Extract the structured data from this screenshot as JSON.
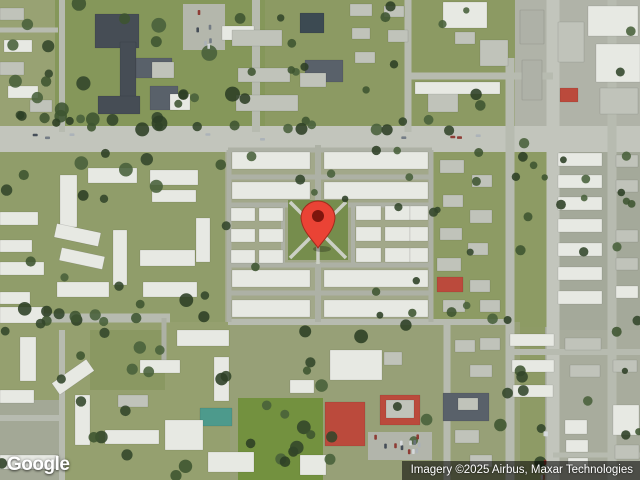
{
  "logo": {
    "text": "Google"
  },
  "attribution": {
    "text": "Imagery ©2025 Airbus, Maxar Technologies"
  },
  "pin": {
    "head_cx": 318,
    "head_cy": 216,
    "head_r": 17,
    "tip_x": 318,
    "tip_y": 248,
    "inner_r": 6,
    "body_color": "#ea4335",
    "border_color": "#a02b1d",
    "inner_color": "#7e150d",
    "shadow_color": "rgba(0,0,0,0.25)"
  },
  "map": {
    "width": 640,
    "height": 480,
    "seed": 13,
    "palette": {
      "w": "#e7e9e3",
      "g": "#c0c3ba",
      "g2": "#aeb1a7",
      "d": "#464d55",
      "d2": "#59616a",
      "r": "#bb4a3c",
      "t": "#4d9a8c",
      "p": "#3c4a52",
      "rd": "#c2c5bc",
      "rd2": "#b7bbb0",
      "rd3": "#adb1a5"
    },
    "tree_colors": [
      "#3e5430",
      "#32462a",
      "#48603a",
      "#2c3f24"
    ],
    "car_colors": [
      "#39414e",
      "#d8dce0",
      "#aab0b8",
      "#6b7480",
      "#8a2f28"
    ],
    "patches": [
      [
        0,
        0,
        640,
        480,
        "#8e9b66"
      ],
      [
        0,
        0,
        60,
        130,
        "#98a273"
      ],
      [
        55,
        0,
        210,
        130,
        "#85975a"
      ],
      [
        183,
        4,
        42,
        46,
        "#b4b7ac"
      ],
      [
        265,
        0,
        250,
        128,
        "#8c9a63"
      ],
      [
        515,
        0,
        125,
        130,
        "#b0b3a8"
      ],
      [
        545,
        130,
        95,
        350,
        "#a4a99a"
      ],
      [
        0,
        150,
        230,
        172,
        "#909d6a"
      ],
      [
        225,
        145,
        210,
        180,
        "#a2a88a"
      ],
      [
        430,
        142,
        120,
        185,
        "#8d9b64"
      ],
      [
        0,
        322,
        230,
        158,
        "#95a06f"
      ],
      [
        230,
        322,
        290,
        158,
        "#97a077"
      ],
      [
        553,
        330,
        87,
        150,
        "#a8ac9d"
      ],
      [
        238,
        398,
        85,
        82,
        "#73913f"
      ],
      [
        0,
        400,
        62,
        80,
        "#a3a896"
      ],
      [
        90,
        330,
        75,
        60,
        "#8a9862"
      ],
      [
        368,
        432,
        64,
        28,
        "#b2b5ab"
      ]
    ],
    "roads": [
      [
        0,
        139,
        640,
        139,
        26,
        "rd"
      ],
      [
        553,
        0,
        553,
        480,
        13,
        "rd"
      ],
      [
        510,
        58,
        510,
        480,
        9,
        "rd2"
      ],
      [
        612,
        0,
        612,
        480,
        9,
        "rd2"
      ],
      [
        256,
        0,
        256,
        132,
        8,
        "rd2"
      ],
      [
        408,
        0,
        408,
        132,
        7,
        "rd2"
      ],
      [
        62,
        0,
        62,
        132,
        6,
        "rd2"
      ],
      [
        408,
        76,
        553,
        76,
        7,
        "rd2"
      ],
      [
        0,
        318,
        170,
        318,
        9,
        "rd2"
      ],
      [
        0,
        30,
        58,
        30,
        5,
        "rd2"
      ],
      [
        228,
        150,
        432,
        150,
        5,
        "rd3"
      ],
      [
        228,
        177,
        432,
        177,
        5,
        "rd3"
      ],
      [
        228,
        205,
        432,
        205,
        5,
        "rd3"
      ],
      [
        228,
        265,
        432,
        265,
        5,
        "rd3"
      ],
      [
        228,
        293,
        432,
        293,
        5,
        "rd3"
      ],
      [
        228,
        322,
        510,
        322,
        6,
        "rd2"
      ],
      [
        229,
        150,
        229,
        322,
        5,
        "rd3"
      ],
      [
        431,
        150,
        431,
        322,
        5,
        "rd3"
      ],
      [
        318,
        145,
        318,
        207,
        6,
        "rd3"
      ],
      [
        318,
        262,
        318,
        322,
        6,
        "rd3"
      ],
      [
        283,
        205,
        283,
        265,
        4,
        "rd3"
      ],
      [
        353,
        205,
        353,
        265,
        4,
        "rd3"
      ],
      [
        447,
        322,
        447,
        480,
        7,
        "rd2"
      ],
      [
        510,
        352,
        640,
        352,
        6,
        "rd2"
      ],
      [
        553,
        455,
        640,
        455,
        5,
        "rd2"
      ],
      [
        0,
        418,
        62,
        418,
        6,
        "rd2"
      ],
      [
        62,
        330,
        62,
        480,
        6,
        "rd2"
      ],
      [
        164,
        318,
        164,
        362,
        5,
        "rd3"
      ]
    ],
    "courtyard": {
      "x": 288,
      "y": 200,
      "w": 60,
      "h": 60,
      "fill": "#768d4d",
      "path_color": "#cbcfc4",
      "circle": {
        "cx": 318,
        "cy": 231,
        "r": 9
      }
    },
    "buildings": [
      [
        95,
        14,
        44,
        34,
        "d"
      ],
      [
        120,
        42,
        16,
        70,
        "d"
      ],
      [
        136,
        58,
        36,
        20,
        "d2"
      ],
      [
        98,
        96,
        42,
        18,
        "d"
      ],
      [
        150,
        86,
        28,
        24,
        "d2"
      ],
      [
        152,
        62,
        22,
        16,
        "g"
      ],
      [
        170,
        94,
        20,
        16,
        "w"
      ],
      [
        4,
        40,
        28,
        12,
        "w"
      ],
      [
        0,
        62,
        24,
        13,
        "g"
      ],
      [
        8,
        86,
        30,
        12,
        "w"
      ],
      [
        0,
        8,
        24,
        12,
        "g"
      ],
      [
        30,
        100,
        22,
        12,
        "g"
      ],
      [
        222,
        26,
        32,
        14,
        "w"
      ],
      [
        232,
        30,
        50,
        16,
        "g"
      ],
      [
        238,
        68,
        52,
        14,
        "g"
      ],
      [
        236,
        95,
        62,
        16,
        "g"
      ],
      [
        305,
        60,
        38,
        22,
        "d2"
      ],
      [
        300,
        73,
        26,
        14,
        "g"
      ],
      [
        300,
        13,
        24,
        20,
        "p"
      ],
      [
        350,
        4,
        22,
        12,
        "g"
      ],
      [
        384,
        6,
        20,
        11,
        "g"
      ],
      [
        352,
        28,
        18,
        11,
        "g"
      ],
      [
        388,
        30,
        20,
        12,
        "g"
      ],
      [
        355,
        52,
        20,
        11,
        "g"
      ],
      [
        443,
        2,
        44,
        26,
        "w"
      ],
      [
        480,
        40,
        28,
        26,
        "g"
      ],
      [
        428,
        92,
        30,
        20,
        "g"
      ],
      [
        415,
        82,
        85,
        12,
        "w"
      ],
      [
        455,
        32,
        20,
        12,
        "g"
      ],
      [
        588,
        6,
        50,
        30,
        "w"
      ],
      [
        596,
        44,
        44,
        38,
        "w"
      ],
      [
        600,
        88,
        38,
        26,
        "g"
      ],
      [
        560,
        88,
        18,
        14,
        "r"
      ],
      [
        558,
        22,
        26,
        40,
        "g"
      ],
      [
        520,
        10,
        24,
        34,
        "g2"
      ],
      [
        522,
        60,
        20,
        40,
        "g2"
      ],
      [
        558,
        153,
        44,
        13,
        "w"
      ],
      [
        558,
        175,
        44,
        13,
        "w"
      ],
      [
        558,
        197,
        44,
        13,
        "w"
      ],
      [
        558,
        219,
        44,
        13,
        "w"
      ],
      [
        558,
        243,
        44,
        13,
        "w"
      ],
      [
        558,
        267,
        44,
        13,
        "w"
      ],
      [
        558,
        291,
        44,
        13,
        "w"
      ],
      [
        616,
        155,
        22,
        12,
        "g"
      ],
      [
        616,
        180,
        22,
        12,
        "g"
      ],
      [
        616,
        230,
        22,
        12,
        "g"
      ],
      [
        616,
        258,
        22,
        12,
        "g"
      ],
      [
        616,
        286,
        22,
        12,
        "w"
      ],
      [
        440,
        160,
        24,
        13,
        "g"
      ],
      [
        472,
        175,
        20,
        12,
        "g"
      ],
      [
        443,
        195,
        20,
        12,
        "g"
      ],
      [
        470,
        210,
        22,
        13,
        "g"
      ],
      [
        440,
        228,
        22,
        12,
        "g"
      ],
      [
        468,
        243,
        20,
        12,
        "g"
      ],
      [
        437,
        258,
        24,
        13,
        "g"
      ],
      [
        437,
        277,
        26,
        15,
        "r"
      ],
      [
        470,
        280,
        20,
        12,
        "g"
      ],
      [
        443,
        300,
        22,
        12,
        "g"
      ],
      [
        480,
        300,
        20,
        12,
        "g"
      ],
      [
        232,
        152,
        78,
        17,
        "w"
      ],
      [
        324,
        152,
        104,
        17,
        "w"
      ],
      [
        232,
        182,
        78,
        17,
        "w"
      ],
      [
        324,
        182,
        104,
        17,
        "w"
      ],
      [
        231,
        208,
        24,
        13,
        "w"
      ],
      [
        259,
        208,
        24,
        13,
        "w"
      ],
      [
        231,
        229,
        24,
        13,
        "w"
      ],
      [
        259,
        229,
        24,
        13,
        "w"
      ],
      [
        231,
        250,
        24,
        13,
        "w"
      ],
      [
        259,
        250,
        24,
        13,
        "w"
      ],
      [
        356,
        206,
        25,
        14,
        "w"
      ],
      [
        385,
        206,
        25,
        14,
        "w"
      ],
      [
        356,
        227,
        25,
        14,
        "w"
      ],
      [
        385,
        227,
        25,
        14,
        "w"
      ],
      [
        356,
        248,
        25,
        14,
        "w"
      ],
      [
        385,
        248,
        25,
        14,
        "w"
      ],
      [
        410,
        206,
        18,
        14,
        "w"
      ],
      [
        410,
        227,
        18,
        14,
        "w"
      ],
      [
        410,
        248,
        18,
        14,
        "w"
      ],
      [
        232,
        270,
        78,
        17,
        "w"
      ],
      [
        324,
        270,
        104,
        17,
        "w"
      ],
      [
        232,
        300,
        78,
        17,
        "w"
      ],
      [
        324,
        300,
        104,
        17,
        "w"
      ],
      [
        60,
        175,
        17,
        52,
        "w"
      ],
      [
        88,
        168,
        49,
        15,
        "w"
      ],
      [
        150,
        170,
        48,
        15,
        "w"
      ],
      [
        152,
        190,
        44,
        12,
        "w"
      ],
      [
        55,
        228,
        45,
        14,
        "w",
        12
      ],
      [
        60,
        252,
        44,
        13,
        "w",
        12
      ],
      [
        113,
        230,
        14,
        55,
        "w"
      ],
      [
        140,
        250,
        55,
        16,
        "w"
      ],
      [
        57,
        282,
        52,
        15,
        "w"
      ],
      [
        143,
        282,
        54,
        15,
        "w"
      ],
      [
        0,
        212,
        38,
        13,
        "w"
      ],
      [
        0,
        240,
        32,
        12,
        "w"
      ],
      [
        0,
        262,
        44,
        13,
        "w"
      ],
      [
        0,
        292,
        30,
        12,
        "w"
      ],
      [
        196,
        218,
        14,
        44,
        "w"
      ],
      [
        0,
        307,
        44,
        16,
        "w"
      ],
      [
        20,
        337,
        16,
        44,
        "w"
      ],
      [
        0,
        390,
        34,
        13,
        "w"
      ],
      [
        52,
        370,
        42,
        14,
        "w",
        -35
      ],
      [
        177,
        330,
        52,
        16,
        "w"
      ],
      [
        75,
        395,
        15,
        50,
        "w"
      ],
      [
        105,
        430,
        54,
        14,
        "w"
      ],
      [
        0,
        455,
        58,
        14,
        "w"
      ],
      [
        140,
        360,
        40,
        13,
        "w"
      ],
      [
        214,
        357,
        15,
        44,
        "w"
      ],
      [
        208,
        452,
        46,
        20,
        "w"
      ],
      [
        300,
        455,
        26,
        20,
        "w"
      ],
      [
        118,
        395,
        30,
        12,
        "g"
      ],
      [
        330,
        350,
        52,
        30,
        "w"
      ],
      [
        384,
        352,
        18,
        13,
        "g"
      ],
      [
        443,
        393,
        46,
        28,
        "d2"
      ],
      [
        325,
        402,
        40,
        44,
        "r"
      ],
      [
        380,
        395,
        40,
        30,
        "r"
      ],
      [
        386,
        400,
        28,
        18,
        "g"
      ],
      [
        200,
        408,
        32,
        18,
        "t"
      ],
      [
        165,
        420,
        38,
        30,
        "w"
      ],
      [
        290,
        380,
        24,
        13,
        "w"
      ],
      [
        455,
        340,
        20,
        12,
        "g"
      ],
      [
        480,
        338,
        20,
        12,
        "g"
      ],
      [
        470,
        365,
        22,
        12,
        "g"
      ],
      [
        455,
        430,
        24,
        13,
        "g"
      ],
      [
        470,
        455,
        22,
        12,
        "g"
      ],
      [
        458,
        398,
        20,
        12,
        "g"
      ],
      [
        510,
        334,
        44,
        12,
        "w"
      ],
      [
        512,
        360,
        42,
        12,
        "w"
      ],
      [
        565,
        338,
        36,
        12,
        "g"
      ],
      [
        570,
        365,
        30,
        12,
        "g"
      ],
      [
        513,
        385,
        40,
        12,
        "w"
      ],
      [
        565,
        420,
        22,
        14,
        "w"
      ],
      [
        566,
        440,
        22,
        12,
        "w"
      ],
      [
        568,
        458,
        20,
        12,
        "w"
      ],
      [
        613,
        405,
        26,
        30,
        "w"
      ],
      [
        613,
        360,
        24,
        12,
        "g"
      ],
      [
        615,
        445,
        24,
        14,
        "g"
      ]
    ],
    "tree_zones": [
      [
        0,
        115,
        540,
        16,
        22,
        4,
        7
      ],
      [
        55,
        0,
        205,
        125,
        16,
        4,
        8
      ],
      [
        228,
        145,
        205,
        178,
        14,
        3,
        5
      ],
      [
        0,
        150,
        228,
        172,
        20,
        4,
        7
      ],
      [
        0,
        322,
        230,
        156,
        18,
        4,
        7
      ],
      [
        230,
        325,
        215,
        150,
        14,
        4,
        7
      ],
      [
        432,
        142,
        118,
        183,
        16,
        3,
        6
      ],
      [
        555,
        132,
        80,
        345,
        12,
        3,
        5
      ],
      [
        262,
        0,
        250,
        125,
        14,
        3,
        6
      ],
      [
        0,
        310,
        170,
        14,
        8,
        4,
        6
      ],
      [
        0,
        0,
        58,
        128,
        8,
        4,
        7
      ],
      [
        614,
        0,
        26,
        478,
        6,
        3,
        5
      ],
      [
        240,
        400,
        80,
        78,
        6,
        4,
        7
      ],
      [
        500,
        355,
        50,
        120,
        7,
        4,
        7
      ]
    ],
    "car_zones": [
      [
        20,
        132,
        500,
        6,
        9,
        1
      ],
      [
        370,
        434,
        58,
        22,
        12,
        0
      ],
      [
        540,
        430,
        8,
        48,
        5,
        0
      ],
      [
        186,
        8,
        34,
        38,
        6,
        0
      ]
    ]
  }
}
